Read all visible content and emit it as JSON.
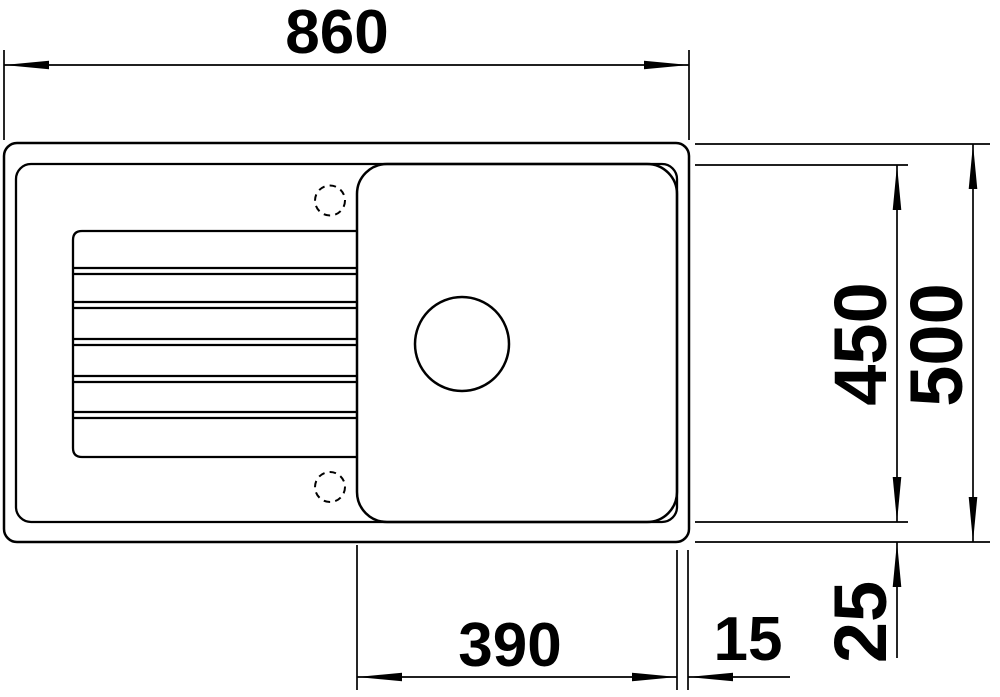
{
  "diagram": {
    "type": "technical-drawing",
    "view": "top-view",
    "subject": "kitchen sink with drainboard and single bowl",
    "units": "mm",
    "colors": {
      "line": "#000000",
      "background": "#ffffff"
    },
    "dimensions": {
      "overall_width": "860",
      "overall_depth": "500",
      "inner_depth": "450",
      "bowl_width": "390",
      "right_rim": "15",
      "bottom_rim": "25"
    },
    "features": {
      "tap_holes": 2,
      "drainboard_grooves": 5,
      "drain_holes": 1
    }
  }
}
